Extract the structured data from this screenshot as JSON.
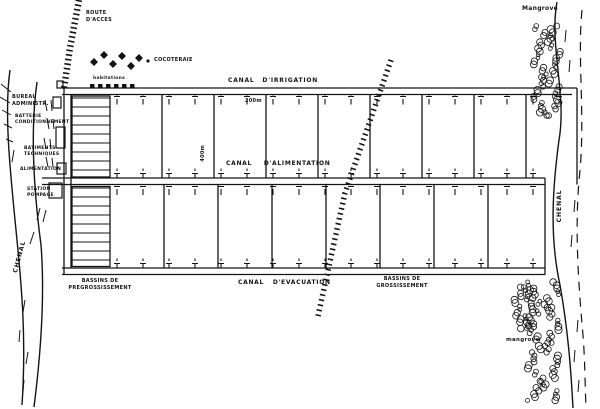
{
  "figure": {
    "type": "hand-drawn aquaculture site plan",
    "labels": {
      "route_acces": "ROUTE\nD'ACCES",
      "cocoteraie": "COCOTERAIE",
      "habitations": "habitations",
      "bureau_administratif": "BUREAU\nADMINISTR.",
      "batterie_conditionnement": "BATTERIE\nCONDITIONNEMENT",
      "batiments_techniques": "BATIMENTS\nTECHNIQUES",
      "alimentation": "ALIMENTATION",
      "station_pompage": "STATION\nPOMPAGE",
      "bassins_pregrossissement": "BASSINS DE\nPREGROSSISSEMENT",
      "canal_irrigation": "CANAL D'IRRIGATION",
      "canal_alimentation": "CANAL D'ALIMENTATION",
      "canal_evacuation": "CANAL D'EVACUATION",
      "bassins_grossissement": "BASSINS DE\nGROSSISSEMENT",
      "dim_200m": "200m",
      "dim_400m": "400m",
      "mangrove_top": "Mangrove",
      "mangrove_bottom": "mangrove",
      "chenal_left": "CHENAL",
      "chenal_right": "CHENAL"
    },
    "colors": {
      "ink": "#141414",
      "paper": "#ffffff"
    }
  }
}
